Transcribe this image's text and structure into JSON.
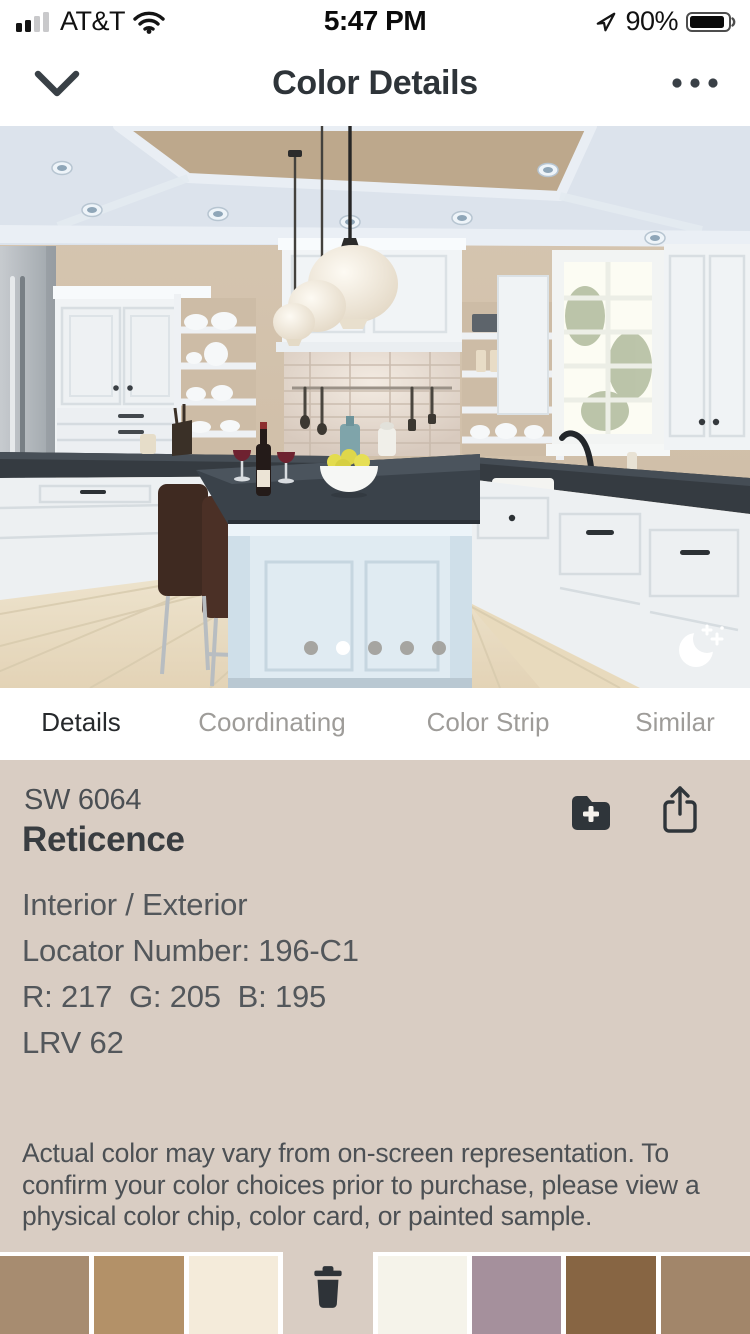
{
  "status_bar": {
    "carrier": "AT&T",
    "time": "5:47 PM",
    "battery": "90%"
  },
  "nav_bar": {
    "title": "Color Details"
  },
  "photo_carousel": {
    "dot_count": 5,
    "active_dot": 1,
    "moon_icon": "night-mode-toggle"
  },
  "tab_bar": {
    "active": "Details",
    "tabs": [
      {
        "label": "Details"
      },
      {
        "label": "Coordinating"
      },
      {
        "label": "Color Strip"
      },
      {
        "label": "Similar"
      }
    ]
  },
  "color_details": {
    "code": "SW 6064",
    "name": "Reticence",
    "usage": "Interior / Exterior",
    "locator": "Locator Number: 196-C1",
    "rgb": "R: 217  G: 205  B: 195",
    "lrv": "LRV 62",
    "swatch_hex": "#d9cdc3"
  },
  "disclaimer": "Actual color may vary from on-screen representation. To confirm your color choices prior to purchase, please view a physical color chip, color card, or painted sample.",
  "palette_bar": {
    "slots": [
      {
        "hex": "#a78c70"
      },
      {
        "hex": "#b39168"
      },
      {
        "hex": "#f4ebda"
      },
      {
        "trash": true
      },
      {
        "hex": "#f5f3ea"
      },
      {
        "hex": "#a5909c"
      },
      {
        "hex": "#876543"
      },
      {
        "hex": "#a2866a"
      }
    ]
  },
  "colors": {
    "accent_dark": "#2f353a",
    "tab_inactive": "#9e9c99",
    "page_bg": "#d9cdc3"
  }
}
